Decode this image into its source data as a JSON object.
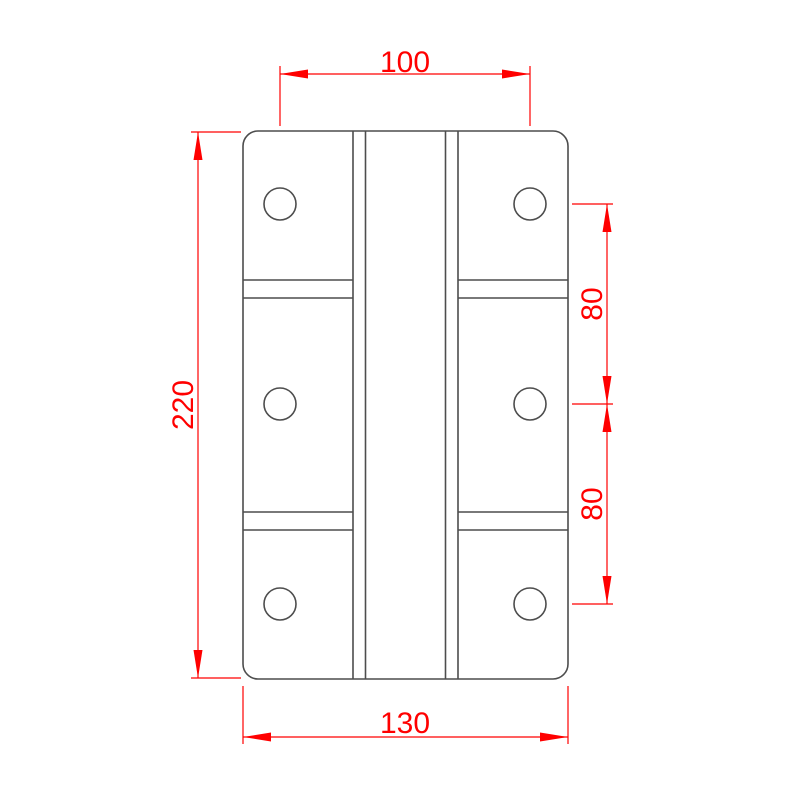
{
  "drawing": {
    "labels": {
      "dim_top_width": "100",
      "dim_left_height": "220",
      "dim_right_upper_spacing": "80",
      "dim_right_lower_spacing": "80",
      "dim_bottom_width": "130"
    },
    "colors": {
      "dimension_red": "#ff0000",
      "outline_gray": "#4d4d4d",
      "background": "#ffffff"
    }
  }
}
